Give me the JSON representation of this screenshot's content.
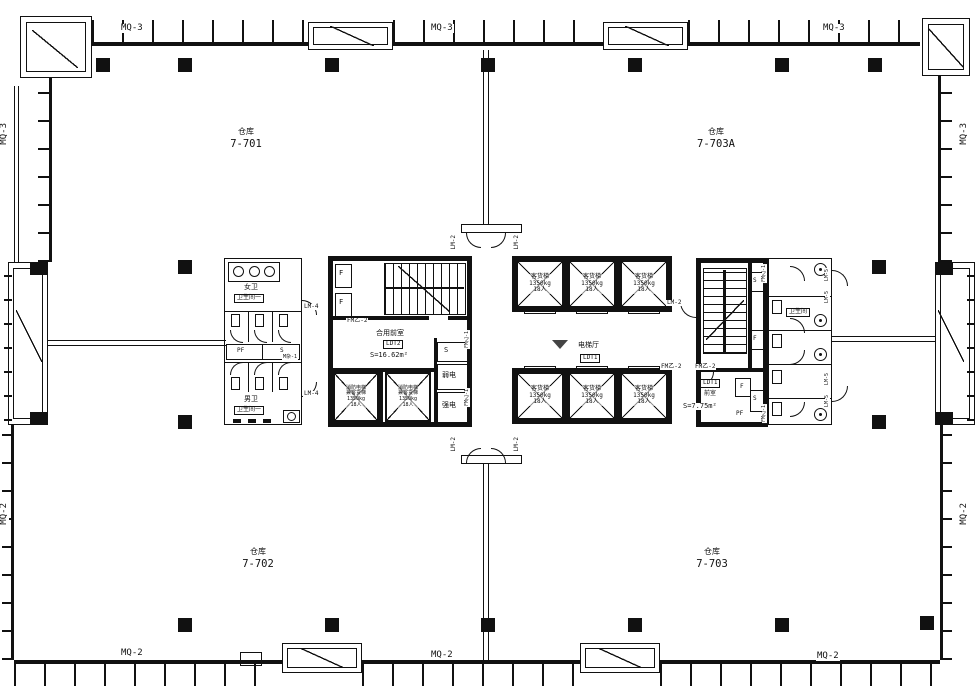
{
  "wall_tags": {
    "mq3_top_1": "MQ-3",
    "mq3_top_2": "MQ-3",
    "mq3_top_3": "MQ-3",
    "mq2_bottom_1": "MQ-2",
    "mq2_bottom_2": "MQ-2",
    "mq2_bottom_3": "MQ-2",
    "mq3_left": "MQ-3",
    "mq2_left": "MQ-2",
    "mq3_right": "MQ-3",
    "mq2_right": "MQ-2"
  },
  "rooms": {
    "wh701": {
      "type": "仓库",
      "no": "7-701"
    },
    "wh703a": {
      "type": "仓库",
      "no": "7-703A"
    },
    "wh702": {
      "type": "仓库",
      "no": "7-702"
    },
    "wh703": {
      "type": "仓库",
      "no": "7-703"
    }
  },
  "core": {
    "female_wc": "女卫",
    "female_wc_tag": "卫生间一",
    "male_wc": "男卫",
    "male_wc_tag": "卫生间一",
    "pf": "PF",
    "s": "S",
    "m_misc": "M杂-1",
    "lm4_upper": "LM-4",
    "lm4_lower": "LM-4",
    "f_upper": "F",
    "f_lower": "F",
    "fmy2_left": "FM乙-2",
    "shared_vest": "合用前室",
    "shared_vest_tag": "LDT2",
    "shared_vest_area": "S=16.62m²",
    "fire_lift_l1": "消防电梯",
    "fire_lift_l2": "兼客货梯",
    "fire_lift_cap": "1350kg",
    "fire_lift_ppl": "18人",
    "s_shaft": "S",
    "weak_elec": "弱电",
    "strong_elec": "强电",
    "fmy1_a": "FM乙-1",
    "fmy1_b": "FM乙-1",
    "lm2_nw": "LM-2",
    "lm2_ne": "LM-2",
    "lm2_sw": "LM-2",
    "lm2_se": "LM-2",
    "lm2_stair": "LM-2",
    "lift": "客货梯",
    "lift_cap": "1350kg",
    "lift_ppl": "18人",
    "hall": "电梯厅",
    "hall_tag": "LDT1",
    "fmy2_r1": "FM乙-2",
    "fmy2_r2": "FM乙-2",
    "vest_tag": "LDT1",
    "vest": "前室",
    "vest_area": "S=7.75m²",
    "f_box": "F",
    "pf_r": "PF",
    "rs_s1": "S",
    "rs_f": "F",
    "rs_s2": "S",
    "fmy1_r1": "FM乙-1",
    "fmy1_r2": "FM乙-1",
    "wc_tag": "卫生间",
    "lm5_1": "LM-5",
    "lm5_2": "LM-5",
    "lm5_3": "LM-5",
    "lm5_4": "LM-5"
  },
  "colors": {
    "line": "#111111",
    "bg": "#ffffff"
  }
}
